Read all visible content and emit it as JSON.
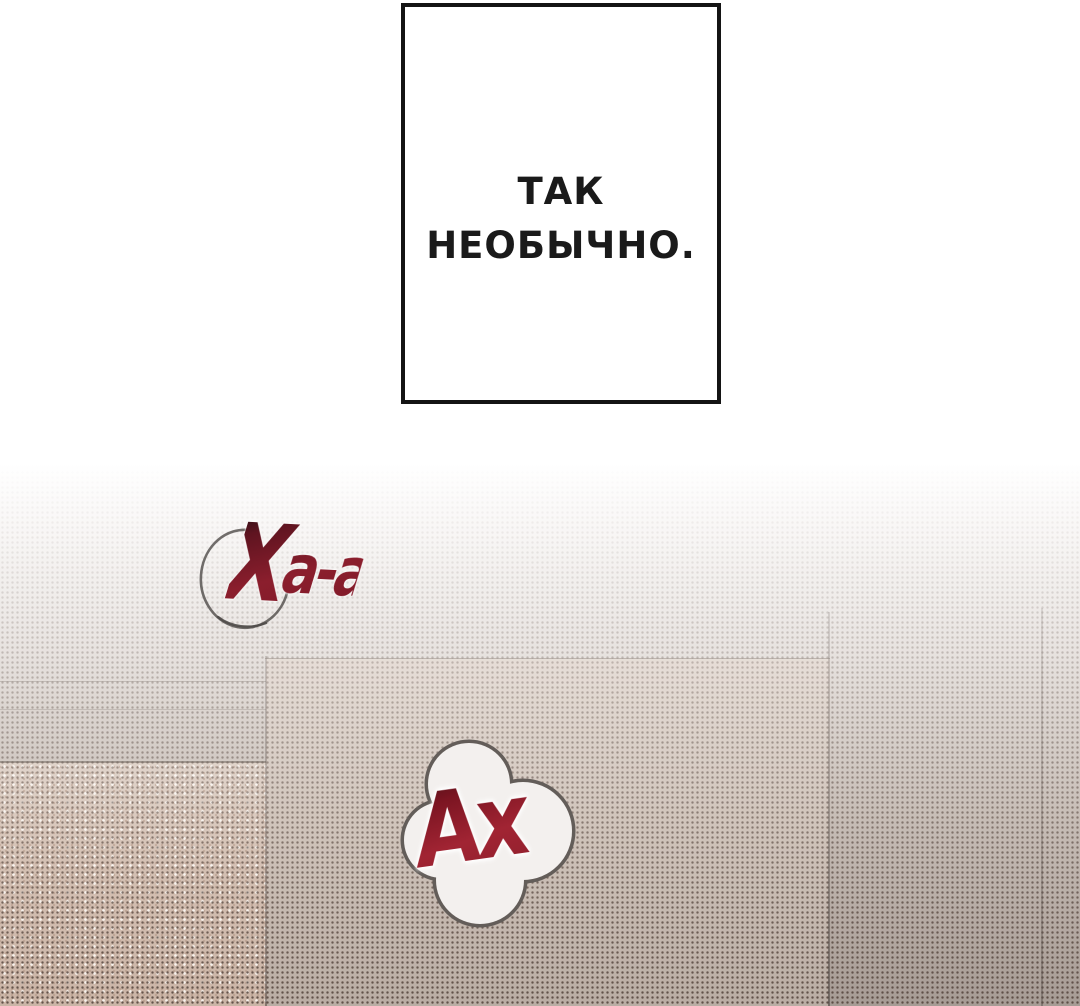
{
  "panel": {
    "speech_box": {
      "lines": [
        "ТАК",
        "НЕОБЫЧНО."
      ]
    },
    "sfx_ha": {
      "first": "Х",
      "rest": "а-а"
    },
    "sfx_ah": {
      "text": "Ах"
    }
  },
  "colors": {
    "bg_bottom": "#a79c95",
    "beige": "#cbb5a7",
    "box_border": "#141414",
    "ink": "#1a1a1a",
    "sfx_red": "#8b1e2d",
    "sfx_red_dark": "#1c0d12",
    "sfx_ah_red": "#a12433",
    "sfx_ah_dark": "#4a1016",
    "sketch_gray": "#4f4b49",
    "cloud_outline": "#635d59",
    "cloud_fill": "#f3f0ee"
  }
}
